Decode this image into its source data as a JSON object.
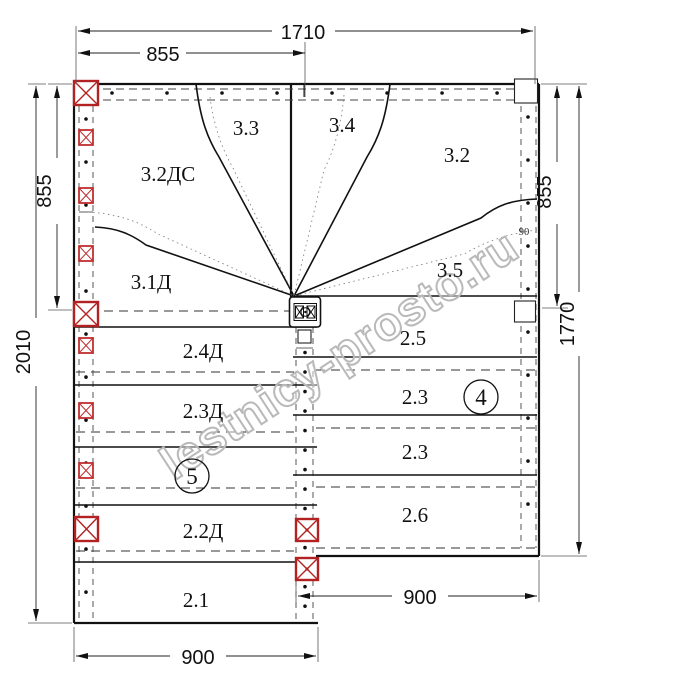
{
  "drawing_title": "Staircase plan (top view)",
  "dimensions": {
    "top_total": "1710",
    "top_half": "855",
    "left_upper": "855",
    "left_total": "2010",
    "right_upper": "855",
    "right_total": "1770",
    "bottom_left": "900",
    "bottom_right": "900",
    "stringer_width": "90"
  },
  "labels": {
    "winder": {
      "w31d": "3.1Д",
      "w32ds": "3.2ДС",
      "w33": "3.3",
      "w34": "3.4",
      "w32": "3.2",
      "w35": "3.5"
    },
    "left_flight": {
      "r1": "2.4Д",
      "r2": "2.3Д",
      "r3": "2.2Д",
      "r4": "2.1"
    },
    "right_flight": {
      "r1": "2.5",
      "r2": "2.3",
      "r3": "2.3",
      "r4": "2.6"
    },
    "balloons": {
      "left": "5",
      "right": "4"
    }
  },
  "watermark": {
    "text": "lestnicy-prosto.ru"
  },
  "colors": {
    "post_red": "#b22222",
    "line": "#111111",
    "watermark": "#b9b9b9"
  }
}
